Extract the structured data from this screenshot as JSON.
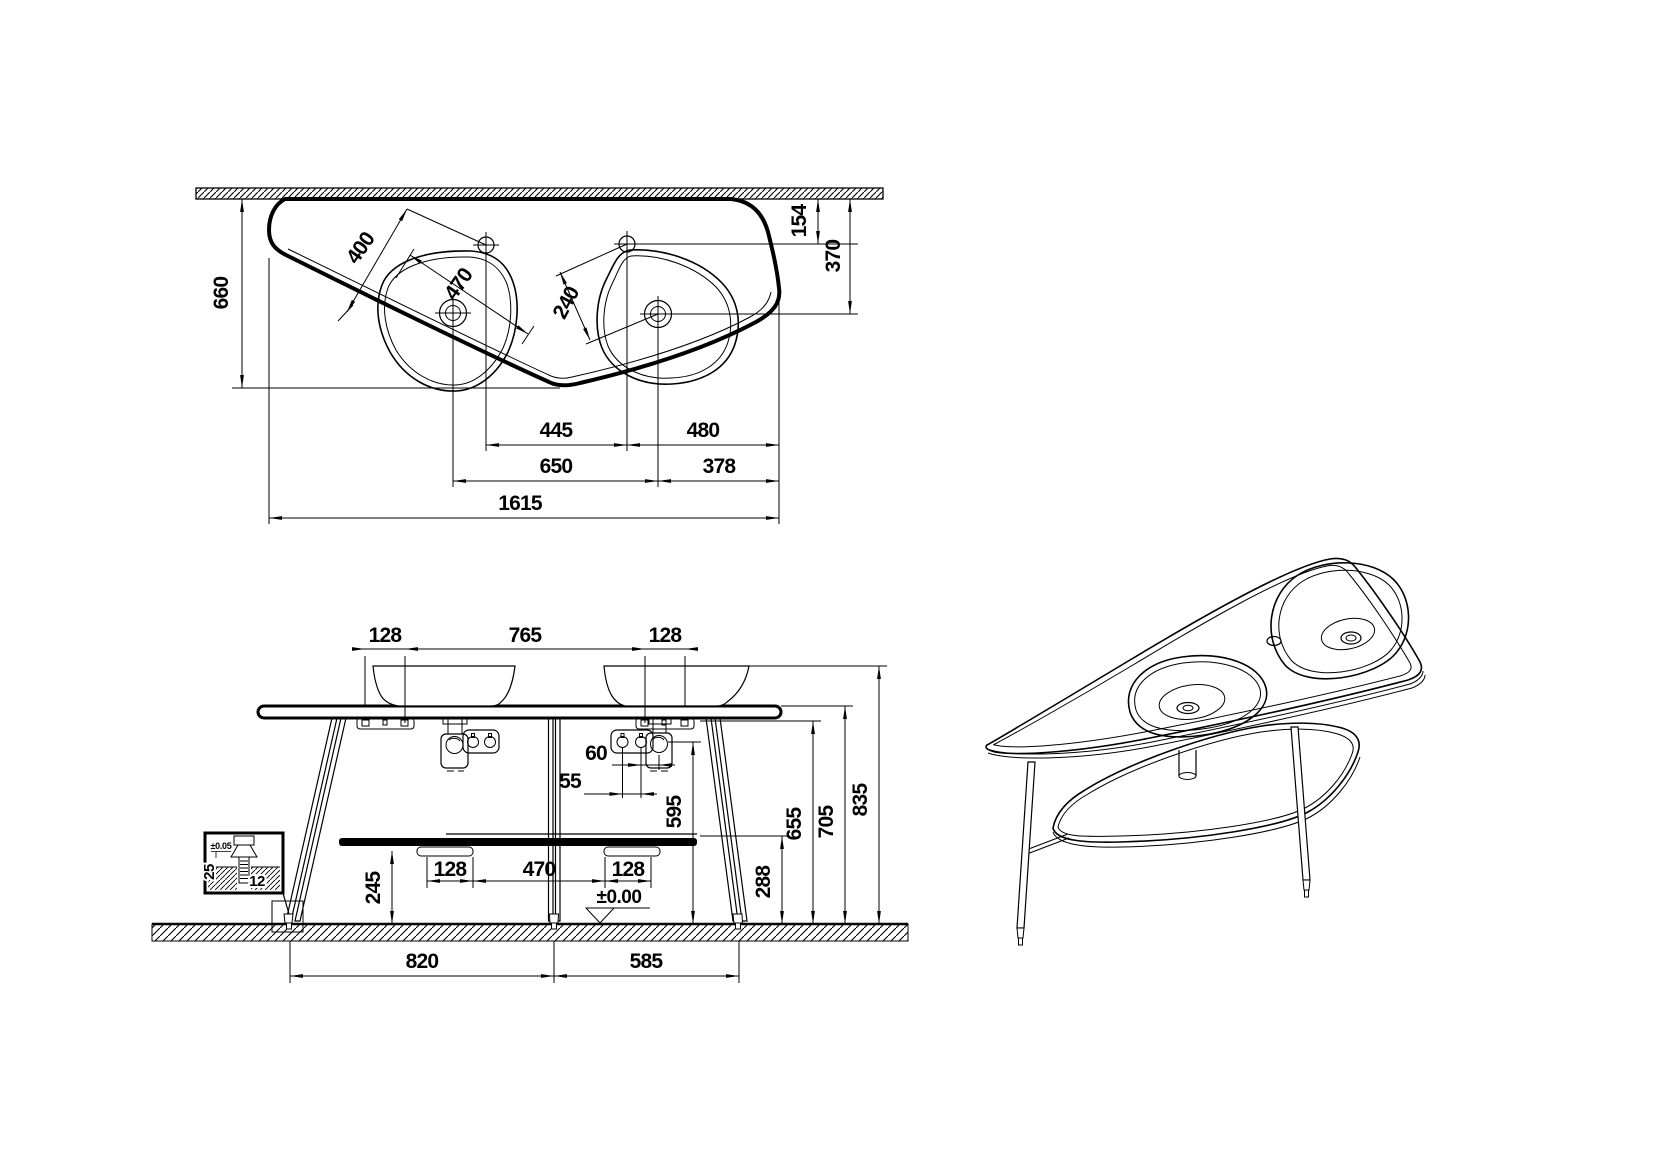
{
  "meta": {
    "background": "#ffffff",
    "ink": "#000000",
    "drawing_type": "technical washbasin installation drawing"
  },
  "plan": {
    "dims": {
      "d660": "660",
      "d400": "400",
      "d470": "470",
      "d240": "240",
      "d154": "154",
      "d370": "370",
      "d445": "445",
      "d480": "480",
      "d650": "650",
      "d378": "378",
      "d1615": "1615"
    }
  },
  "elevation": {
    "dims": {
      "d128a": "128",
      "d765": "765",
      "d128b": "128",
      "d60": "60",
      "d55": "55",
      "d595": "595",
      "d245": "245",
      "d128c": "128",
      "d470": "470",
      "d128d": "128",
      "d288": "288",
      "d655": "655",
      "d705": "705",
      "d835": "835",
      "d820": "820",
      "d585": "585",
      "datum": "±0.00"
    },
    "detail": {
      "tol": "±0.05",
      "d25": "25",
      "d12": "12"
    }
  }
}
